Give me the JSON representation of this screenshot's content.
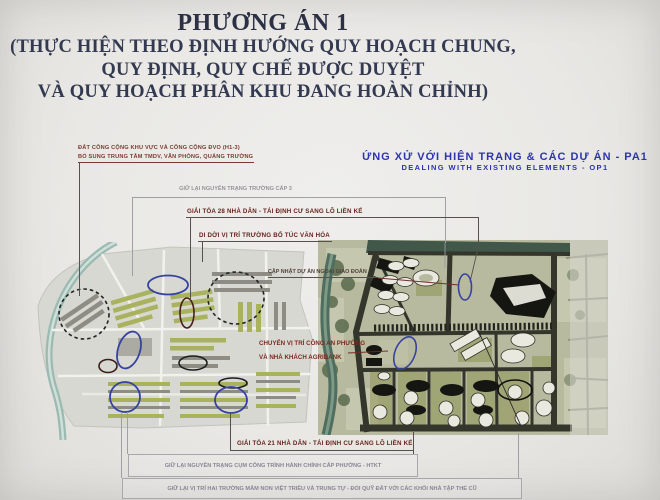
{
  "slide": {
    "title": "PHƯƠNG ÁN 1",
    "subtitle_lines": [
      "(THỰC HIỆN THEO ĐỊNH HƯỚNG QUY HOẠCH CHUNG,",
      "QUY ĐỊNH, QUY CHẾ ĐƯỢC DUYỆT",
      "VÀ QUY HOẠCH PHÂN KHU ĐANG HOÀN CHỈNH)"
    ]
  },
  "section_heading": {
    "vi": "ỨNG XỬ VỚI HIỆN TRẠNG & CÁC DỰ ÁN - PA1",
    "en": "DEALING WITH EXISTING ELEMENTS - OP1"
  },
  "annotations": {
    "public_land": {
      "line1": "ĐẤT CÔNG CỘNG KHU VỰC VÀ CÔNG CỘNG ĐVO (H1-3)",
      "line2": "BỔ SUNG TRUNG TÂM TMDV, VĂN PHÒNG, QUẢNG TRƯỜNG"
    },
    "keep_school": "GIỮ LẠI NGUYÊN TRẠNG TRƯỜNG CẤP 3",
    "clear_28": "GIẢI TỎA 28 NHÀ DÂN - TÁI ĐỊNH CƯ SANG LÔ LIỀN KẾ",
    "move_school": "DI DỜI VỊ TRÍ TRƯỜNG BỔ TÚC VĂN HÓA",
    "update_project": "CẬP NHẬT DỰ ÁN NGOẠI GIAO ĐOÀN",
    "move_police": {
      "line1": "CHUYỂN VỊ TRÍ CÔNG AN PHƯỜNG",
      "line2": "VÀ NHÀ KHÁCH AGRIBANK"
    },
    "clear_21": "GIẢI TỎA 21 NHÀ DÂN - TÁI ĐỊNH CƯ SANG LÔ LIỀN KẾ",
    "keep_admin": "GIỮ LẠI NGUYÊN TRẠNG CỤM CÔNG TRÌNH HÀNH CHÍNH CẤP PHƯỜNG - HTKT",
    "keep_kindergarten": "GIỮ LẠI VỊ TRÍ HAI TRƯỜNG MẦM NON VIỆT TRIỀU VÀ TRUNG TỰ - ĐỔI QUỸ ĐẤT VỚI CÁC KHỐI NHÀ TẬP THỂ CŨ"
  },
  "colors": {
    "title_navy": "#2b3044",
    "heading_blue": "#2c34ae",
    "label_maroon": "#66241c",
    "label_grey": "#97939c",
    "annotation_blue": "#3642a0",
    "annotation_black": "#1c1c1c"
  }
}
